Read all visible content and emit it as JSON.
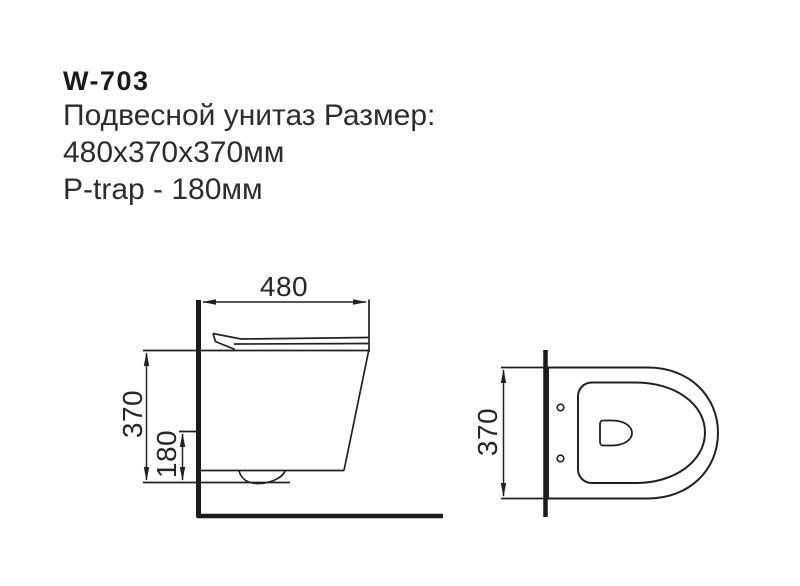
{
  "header": {
    "model": "W-703",
    "title_line": "Подвесной унитаз Размер:",
    "size_line": "480x370x370мм",
    "trap_line": "P-trap - 180мм"
  },
  "drawing": {
    "side_view": {
      "width_label": "480",
      "height_label": "370",
      "trap_height_label": "180"
    },
    "top_view": {
      "width_label": "370"
    }
  },
  "colors": {
    "background": "#ffffff",
    "line": "#212121",
    "text": "#2d2d2d"
  }
}
